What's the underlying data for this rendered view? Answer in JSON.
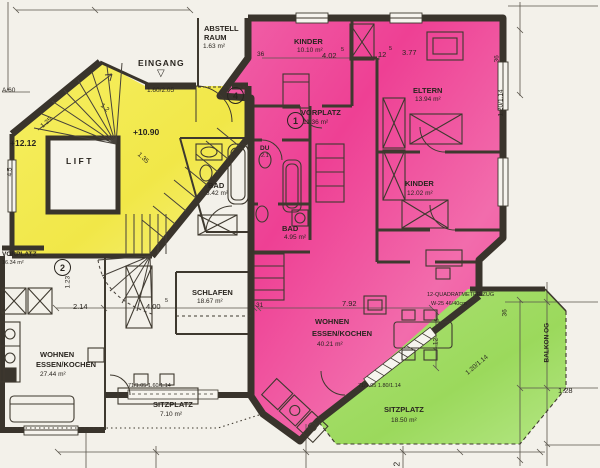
{
  "colors": {
    "pink": "#ee4f9c",
    "yellow": "#f2ea54",
    "green": "#a2dc66",
    "wall": "#3a352d",
    "paper": "#f3f1ea"
  },
  "markers": {
    "unit1": "1",
    "unit2": "2",
    "unit4": "4"
  },
  "rooms": {
    "abstellraum": {
      "line1": "ABSTELL",
      "line2": "RAUM",
      "area": "1.63 m²"
    },
    "eingang": {
      "label": "EINGANG",
      "arrow": "▽"
    },
    "kinder_nord": {
      "name": "KINDER",
      "area": "10.10 m²"
    },
    "eltern": {
      "name": "ELTERN",
      "area": "13.94 m²"
    },
    "vorplatz_og": {
      "name": "VORPLATZ",
      "area": "11.36 m²"
    },
    "dusche": {
      "name": "DU",
      "area": "2.1"
    },
    "bad_west": {
      "name": "BAD",
      "area": "3.42 m²"
    },
    "bad_ost": {
      "name": "BAD",
      "area": "4.95 m²"
    },
    "kinder_ost": {
      "name": "KINDER",
      "area": "12.02 m²"
    },
    "vorplatz_west": {
      "name": "VORPLATZ",
      "area": "16.34 m²"
    },
    "schlafen": {
      "name": "SCHLAFEN",
      "area": "18.67 m²"
    },
    "wohnen_west": {
      "line1": "WOHNEN",
      "line2": "ESSEN/KOCHEN",
      "area": "27.44 m²"
    },
    "wohnen_ost": {
      "line1": "WOHNEN",
      "line2": "ESSEN/KOCHEN",
      "area": "40.21 m²"
    },
    "sitzplatz_west": {
      "name": "SITZPLATZ",
      "area": "7.10 m²"
    },
    "sitzplatz_ost": {
      "name": "SITZPLATZ",
      "area": "18.50 m²"
    },
    "lift": {
      "name": "LIFT"
    },
    "balkon": {
      "name": "BALKON OG"
    }
  },
  "levels": {
    "stair_upper": "+12.12",
    "entry": "+10.90"
  },
  "dims": {
    "w402": "4.02",
    "sup5": "5",
    "w377": "3.77",
    "w12": "12",
    "t36": "36",
    "door_eingang": "1.60/2.05",
    "a60": "A/60",
    "h45": "4.5",
    "s125": "1.25",
    "s12": "1.2",
    "s135": "1.35",
    "s123": "1.23",
    "w214": "2.14",
    "w400": "4.00",
    "t31": "31",
    "w792": "7.92",
    "h412": "4.12",
    "w128": "1.28",
    "win_right": "1.20/1.14",
    "win_diag": "1.20/1.14",
    "doors_west": "71/1.05  1.60/1.14",
    "doors_green": "71/1.05  1.80/1.14",
    "note1": "12-QUADRATMETER-ZUG",
    "note2": "W-25 46/40cm",
    "t2": "2"
  }
}
